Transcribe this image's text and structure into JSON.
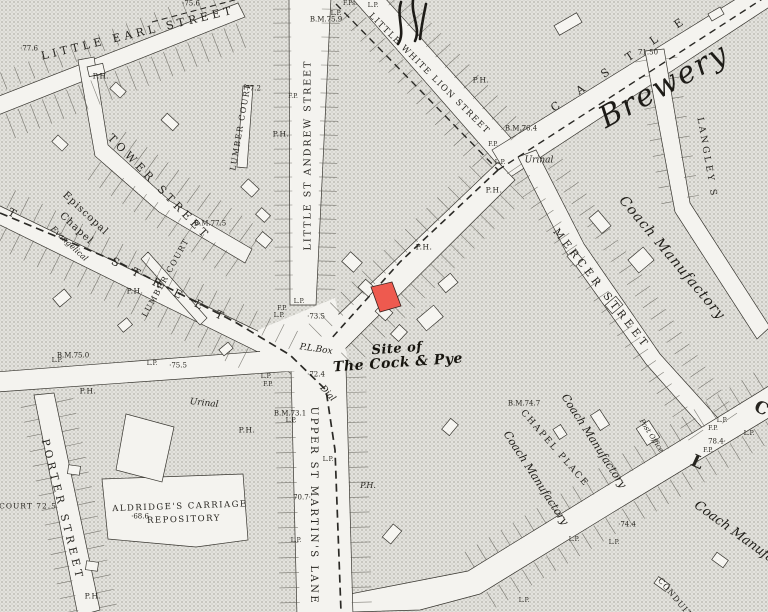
{
  "map": {
    "colors": {
      "paper": "#f4f3ef",
      "block_base": "#e3e2dd",
      "halftone_dot": "#b9b8b1",
      "line": "#37352f",
      "highlight_parcel": "#ee5a4f",
      "text": "#26241f"
    },
    "highlight": {
      "name": "red-highlighted-parcel",
      "color": "#ee5a4f"
    },
    "labels": [
      {
        "text": "LITTLE EARL STREET",
        "x": 138,
        "y": 33,
        "rot": -13.5,
        "cls": "street",
        "fs": 11,
        "ls": 4
      },
      {
        "text": "TOWER STREET",
        "x": 159,
        "y": 187,
        "rot": 46,
        "cls": "street",
        "fs": 11,
        "ls": 4
      },
      {
        "text": "LITTLE ST ANDREW STREET",
        "x": 308,
        "y": 155,
        "rot": -90,
        "cls": "street",
        "fs": 9.5,
        "ls": 2
      },
      {
        "text": "LITTLE WHITE LION STREET",
        "x": 429,
        "y": 74,
        "rot": 45,
        "cls": "street",
        "fs": 8.5,
        "ls": 1.5
      },
      {
        "text": "CASTLE",
        "x": 626,
        "y": 59,
        "rot": -34,
        "cls": "street",
        "fs": 11,
        "ls": 22
      },
      {
        "text": "LANGLEY S",
        "x": 706,
        "y": 158,
        "rot": 80,
        "cls": "street",
        "fs": 9,
        "ls": 3
      },
      {
        "text": "MERCER STREET",
        "x": 601,
        "y": 289,
        "rot": 52,
        "cls": "street",
        "fs": 10.5,
        "ls": 4
      },
      {
        "text": "UPPER ST MARTIN'S LANE",
        "x": 313,
        "y": 506,
        "rot": 90,
        "cls": "street",
        "fs": 10,
        "ls": 2.5
      },
      {
        "text": "PORTER STREET",
        "x": 62,
        "y": 510,
        "rot": 76,
        "cls": "street",
        "fs": 10.5,
        "ls": 4
      },
      {
        "text": "LUMBER COURT",
        "x": 241,
        "y": 127,
        "rot": -80,
        "cls": "street-sm",
        "fs": 8,
        "ls": 1.5
      },
      {
        "text": "LUMBER COURT",
        "x": 166,
        "y": 278,
        "rot": -61,
        "cls": "street-sm",
        "fs": 8,
        "ls": 1.5
      },
      {
        "text": "CHAPEL PLACE",
        "x": 554,
        "y": 449,
        "rot": 49,
        "cls": "street-sm",
        "fs": 9,
        "ls": 2
      },
      {
        "text": "T",
        "x": 12,
        "y": 213,
        "rot": 28,
        "cls": "street",
        "fs": 11,
        "ls": 0
      },
      {
        "text": "S T R E E T",
        "x": 170,
        "y": 290,
        "rot": 27,
        "cls": "street",
        "fs": 11,
        "ls": 6
      },
      {
        "text": "L",
        "x": 697,
        "y": 463,
        "rot": 25,
        "cls": "letter",
        "fs": 17,
        "ls": 0
      },
      {
        "text": "C",
        "x": 761,
        "y": 409,
        "rot": 25,
        "cls": "letter",
        "fs": 17,
        "ls": 0
      },
      {
        "text": "CONDUIT C",
        "x": 678,
        "y": 602,
        "rot": 50,
        "cls": "street-sm",
        "fs": 8,
        "ls": 1
      },
      {
        "text": "Brewery",
        "x": 664,
        "y": 86,
        "rot": -29,
        "cls": "big-italic",
        "fs": 30,
        "ls": 2
      },
      {
        "text": "Coach Manufactory",
        "x": 672,
        "y": 258,
        "rot": 50,
        "cls": "coach",
        "fs": 14,
        "ls": 1
      },
      {
        "text": "Coach Manufactory",
        "x": 594,
        "y": 441,
        "rot": 57,
        "cls": "coach",
        "fs": 11,
        "ls": 0
      },
      {
        "text": "Coach Manufactory",
        "x": 536,
        "y": 478,
        "rot": 57,
        "cls": "coach",
        "fs": 11,
        "ls": 0
      },
      {
        "text": "Coach Manufactory",
        "x": 748,
        "y": 542,
        "rot": 36,
        "cls": "coach",
        "fs": 13,
        "ls": 0
      },
      {
        "text": "Site of",
        "x": 397,
        "y": 349,
        "rot": -4,
        "cls": "gothic",
        "fs": 13,
        "ls": 0
      },
      {
        "text": "The Cock & Pye",
        "x": 398,
        "y": 363,
        "rot": -4,
        "cls": "gothic",
        "fs": 14,
        "ls": 0
      },
      {
        "text": "Episcopal",
        "x": 85,
        "y": 214,
        "rot": 43,
        "cls": "chapel",
        "fs": 10,
        "ls": 1
      },
      {
        "text": "Chapel",
        "x": 76,
        "y": 229,
        "rot": 43,
        "cls": "chapel",
        "fs": 10,
        "ls": 1
      },
      {
        "text": "Evangelical",
        "x": 69,
        "y": 244,
        "rot": 43,
        "cls": "chapel-it",
        "fs": 8,
        "ls": 0
      },
      {
        "text": "ALDRIDGE'S CARRIAGE",
        "x": 180,
        "y": 507,
        "rot": -2,
        "cls": "street-sm",
        "fs": 8.5,
        "ls": 1.5
      },
      {
        "text": "REPOSITORY",
        "x": 184,
        "y": 520,
        "rot": -2,
        "cls": "street-sm",
        "fs": 8.5,
        "ls": 1.5
      },
      {
        "text": "Urinal",
        "x": 539,
        "y": 161,
        "rot": 0,
        "cls": "italic",
        "fs": 9,
        "ls": 0
      },
      {
        "text": "Urinal",
        "x": 204,
        "y": 404,
        "rot": 6,
        "cls": "italic",
        "fs": 9,
        "ls": 0
      },
      {
        "text": "P.L.Box",
        "x": 316,
        "y": 350,
        "rot": 8,
        "cls": "italic",
        "fs": 9,
        "ls": 0
      },
      {
        "text": "Post Office",
        "x": 651,
        "y": 436,
        "rot": 57,
        "cls": "italic",
        "fs": 7,
        "ls": 0
      },
      {
        "text": "Dial",
        "x": 327,
        "y": 394,
        "rot": 48,
        "cls": "italic",
        "fs": 9,
        "ls": 0
      },
      {
        "text": "P.H.",
        "x": 101,
        "y": 76,
        "rot": 0,
        "cls": "ph",
        "fs": 7.5,
        "ls": 0
      },
      {
        "text": "P.H.",
        "x": 281,
        "y": 134,
        "rot": 0,
        "cls": "ph",
        "fs": 7.5,
        "ls": 0
      },
      {
        "text": "P.H.",
        "x": 481,
        "y": 80,
        "rot": 0,
        "cls": "ph",
        "fs": 7.5,
        "ls": 0
      },
      {
        "text": "P.H.",
        "x": 494,
        "y": 190,
        "rot": 0,
        "cls": "ph",
        "fs": 7.5,
        "ls": 0
      },
      {
        "text": "P.H.",
        "x": 135,
        "y": 291,
        "rot": 0,
        "cls": "ph",
        "fs": 7.5,
        "ls": 0
      },
      {
        "text": "P.H.",
        "x": 424,
        "y": 247,
        "rot": 0,
        "cls": "ph",
        "fs": 7.5,
        "ls": 0
      },
      {
        "text": "P.H.",
        "x": 88,
        "y": 391,
        "rot": 0,
        "cls": "ph",
        "fs": 7.5,
        "ls": 0
      },
      {
        "text": "P.H.",
        "x": 247,
        "y": 430,
        "rot": 0,
        "cls": "ph",
        "fs": 7.5,
        "ls": 0
      },
      {
        "text": "P.H.",
        "x": 93,
        "y": 596,
        "rot": 0,
        "cls": "ph",
        "fs": 7.5,
        "ls": 0
      },
      {
        "text": "P.H.",
        "x": 368,
        "y": 486,
        "rot": 0,
        "cls": "italic",
        "fs": 8,
        "ls": 0
      },
      {
        "text": "·77.6",
        "x": 29,
        "y": 49,
        "rot": 0,
        "cls": "num",
        "fs": 7,
        "ls": 0
      },
      {
        "text": "·75.6",
        "x": 191,
        "y": 4,
        "rot": 0,
        "cls": "num",
        "fs": 7,
        "ls": 0
      },
      {
        "text": "B.M.75.9",
        "x": 326,
        "y": 20,
        "rot": 0,
        "cls": "num",
        "fs": 7,
        "ls": 0
      },
      {
        "text": "·77.2",
        "x": 252,
        "y": 89,
        "rot": 0,
        "cls": "num",
        "fs": 7,
        "ls": 0
      },
      {
        "text": "B.M.77.5",
        "x": 210,
        "y": 224,
        "rot": 0,
        "cls": "num",
        "fs": 7,
        "ls": 0
      },
      {
        "text": "71.50",
        "x": 648,
        "y": 53,
        "rot": 0,
        "cls": "num",
        "fs": 7,
        "ls": 0
      },
      {
        "text": "B.M.76.4",
        "x": 521,
        "y": 129,
        "rot": 0,
        "cls": "num",
        "fs": 7,
        "ls": 0
      },
      {
        "text": "B.M.75.0",
        "x": 73,
        "y": 356,
        "rot": 0,
        "cls": "num",
        "fs": 7,
        "ls": 0
      },
      {
        "text": "·75.5",
        "x": 178,
        "y": 366,
        "rot": 0,
        "cls": "num",
        "fs": 7,
        "ls": 0
      },
      {
        "text": "·73.5",
        "x": 316,
        "y": 317,
        "rot": 0,
        "cls": "num",
        "fs": 7,
        "ls": 0
      },
      {
        "text": "·72.4",
        "x": 316,
        "y": 375,
        "rot": 0,
        "cls": "num",
        "fs": 7,
        "ls": 0
      },
      {
        "text": "B.M.73.1",
        "x": 290,
        "y": 414,
        "rot": 0,
        "cls": "num",
        "fs": 7,
        "ls": 0
      },
      {
        "text": "70.7·",
        "x": 302,
        "y": 498,
        "rot": 0,
        "cls": "num",
        "fs": 7,
        "ls": 0
      },
      {
        "text": "COURT 72.5",
        "x": 28,
        "y": 506,
        "rot": 0,
        "cls": "num",
        "fs": 7.5,
        "ls": 1
      },
      {
        "text": "·68.6",
        "x": 140,
        "y": 517,
        "rot": 0,
        "cls": "num",
        "fs": 7,
        "ls": 0
      },
      {
        "text": "B.M.74.7",
        "x": 524,
        "y": 404,
        "rot": 0,
        "cls": "num",
        "fs": 7,
        "ls": 0
      },
      {
        "text": "·74.4",
        "x": 627,
        "y": 525,
        "rot": 0,
        "cls": "num",
        "fs": 7,
        "ls": 0
      },
      {
        "text": "78.4·",
        "x": 717,
        "y": 442,
        "rot": 0,
        "cls": "num",
        "fs": 7,
        "ls": 0
      },
      {
        "text": "L.P.",
        "x": 336,
        "y": 14,
        "rot": 0,
        "cls": "tiny",
        "fs": 6,
        "ls": 0
      },
      {
        "text": "L.P.",
        "x": 373,
        "y": 6,
        "rot": 0,
        "cls": "tiny",
        "fs": 6,
        "ls": 0
      },
      {
        "text": "F.Ps.",
        "x": 350,
        "y": 4,
        "rot": 0,
        "cls": "tiny",
        "fs": 6,
        "ls": 0
      },
      {
        "text": "F.P.",
        "x": 293,
        "y": 97,
        "rot": 0,
        "cls": "tiny",
        "fs": 6,
        "ls": 0
      },
      {
        "text": "L.P.",
        "x": 299,
        "y": 302,
        "rot": 0,
        "cls": "tiny",
        "fs": 6,
        "ls": 0
      },
      {
        "text": "F.P.",
        "x": 282,
        "y": 309,
        "rot": 0,
        "cls": "tiny",
        "fs": 6,
        "ls": 0
      },
      {
        "text": "L.P.",
        "x": 279,
        "y": 316,
        "rot": 0,
        "cls": "tiny",
        "fs": 6,
        "ls": 0
      },
      {
        "text": "L.P.",
        "x": 266,
        "y": 377,
        "rot": 0,
        "cls": "tiny",
        "fs": 6,
        "ls": 0
      },
      {
        "text": "F.P.",
        "x": 268,
        "y": 385,
        "rot": 0,
        "cls": "tiny",
        "fs": 6,
        "ls": 0
      },
      {
        "text": "L.P.",
        "x": 152,
        "y": 364,
        "rot": 0,
        "cls": "tiny",
        "fs": 6,
        "ls": 0
      },
      {
        "text": "L.P.",
        "x": 57,
        "y": 361,
        "rot": 0,
        "cls": "tiny",
        "fs": 6,
        "ls": 0
      },
      {
        "text": "L.P.",
        "x": 291,
        "y": 421,
        "rot": 0,
        "cls": "tiny",
        "fs": 6,
        "ls": 0
      },
      {
        "text": "L.P.",
        "x": 328,
        "y": 460,
        "rot": 0,
        "cls": "tiny",
        "fs": 6,
        "ls": 0
      },
      {
        "text": "L.P.",
        "x": 296,
        "y": 541,
        "rot": 0,
        "cls": "tiny",
        "fs": 6,
        "ls": 0
      },
      {
        "text": "F.P.",
        "x": 493,
        "y": 145,
        "rot": 0,
        "cls": "tiny",
        "fs": 6,
        "ls": 0
      },
      {
        "text": "L.P.",
        "x": 500,
        "y": 163,
        "rot": 0,
        "cls": "tiny",
        "fs": 6,
        "ls": 0
      },
      {
        "text": "L.P.",
        "x": 722,
        "y": 421,
        "rot": 0,
        "cls": "tiny",
        "fs": 6,
        "ls": 0
      },
      {
        "text": "F.P.",
        "x": 713,
        "y": 429,
        "rot": 0,
        "cls": "tiny",
        "fs": 6,
        "ls": 0
      },
      {
        "text": "F.P.",
        "x": 708,
        "y": 451,
        "rot": 0,
        "cls": "tiny",
        "fs": 6,
        "ls": 0
      },
      {
        "text": "L.P.",
        "x": 749,
        "y": 434,
        "rot": 0,
        "cls": "tiny",
        "fs": 6,
        "ls": 0
      },
      {
        "text": "L.P.",
        "x": 574,
        "y": 540,
        "rot": 0,
        "cls": "tiny",
        "fs": 6,
        "ls": 0
      },
      {
        "text": "L.P.",
        "x": 614,
        "y": 543,
        "rot": 0,
        "cls": "tiny",
        "fs": 6,
        "ls": 0
      },
      {
        "text": "L.P.",
        "x": 524,
        "y": 601,
        "rot": 0,
        "cls": "tiny",
        "fs": 6,
        "ls": 0
      }
    ]
  }
}
